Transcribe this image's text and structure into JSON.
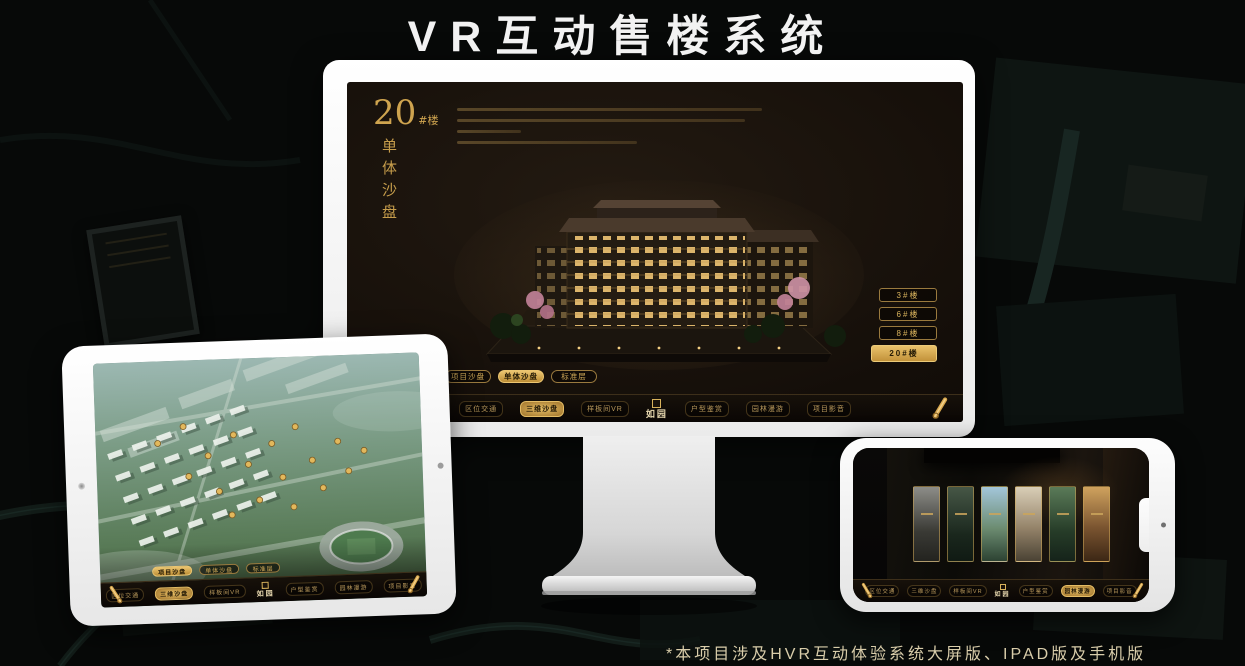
{
  "page": {
    "title_text": "VR互动售楼系统",
    "footnote": "*本项目涉及HVR互动体验系统大屏版、IPAD版及手机版"
  },
  "colors": {
    "gold": "#d0a955",
    "gold_bright": "#ecc671",
    "screen_bg": "#140e09",
    "footnote_text": "#d9cdaa",
    "title_text": "#f2f2f2"
  },
  "icons": {
    "nav_end": "scroll-icon",
    "logo_mark": "seal-icon"
  },
  "monitor": {
    "heading": {
      "number": "20",
      "suffix": "#楼",
      "subtitle": "单体沙盘"
    },
    "building_buttons": [
      {
        "label": "3#楼",
        "active": false
      },
      {
        "label": "6#楼",
        "active": false
      },
      {
        "label": "8#楼",
        "active": false
      },
      {
        "label": "20#楼",
        "active": true
      }
    ],
    "view_tabs": [
      {
        "label": "项目沙盘",
        "active": false
      },
      {
        "label": "单体沙盘",
        "active": true
      },
      {
        "label": "标准层",
        "active": false
      }
    ],
    "nav": {
      "items": [
        "区位交通",
        "三维沙盘",
        "样板间VR",
        "户型鉴赏",
        "园林漫游",
        "项目影音"
      ],
      "active_item": "三维沙盘",
      "logo": "如园"
    }
  },
  "tablet": {
    "view_tabs": [
      {
        "label": "项目沙盘",
        "active": true
      },
      {
        "label": "单体沙盘",
        "active": false
      },
      {
        "label": "标准层",
        "active": false
      }
    ],
    "nav": {
      "items": [
        "区位交通",
        "三维沙盘",
        "样板间VR",
        "户型鉴赏",
        "园林漫游",
        "项目影音"
      ],
      "active_item": "三维沙盘",
      "logo": "如园"
    }
  },
  "phone": {
    "nav": {
      "items": [
        "区位交通",
        "三维沙盘",
        "样板间VR",
        "户型鉴赏",
        "园林漫游",
        "项目影音"
      ],
      "active_item": "园林漫游",
      "logo": "如园"
    },
    "panel_count": "6"
  }
}
